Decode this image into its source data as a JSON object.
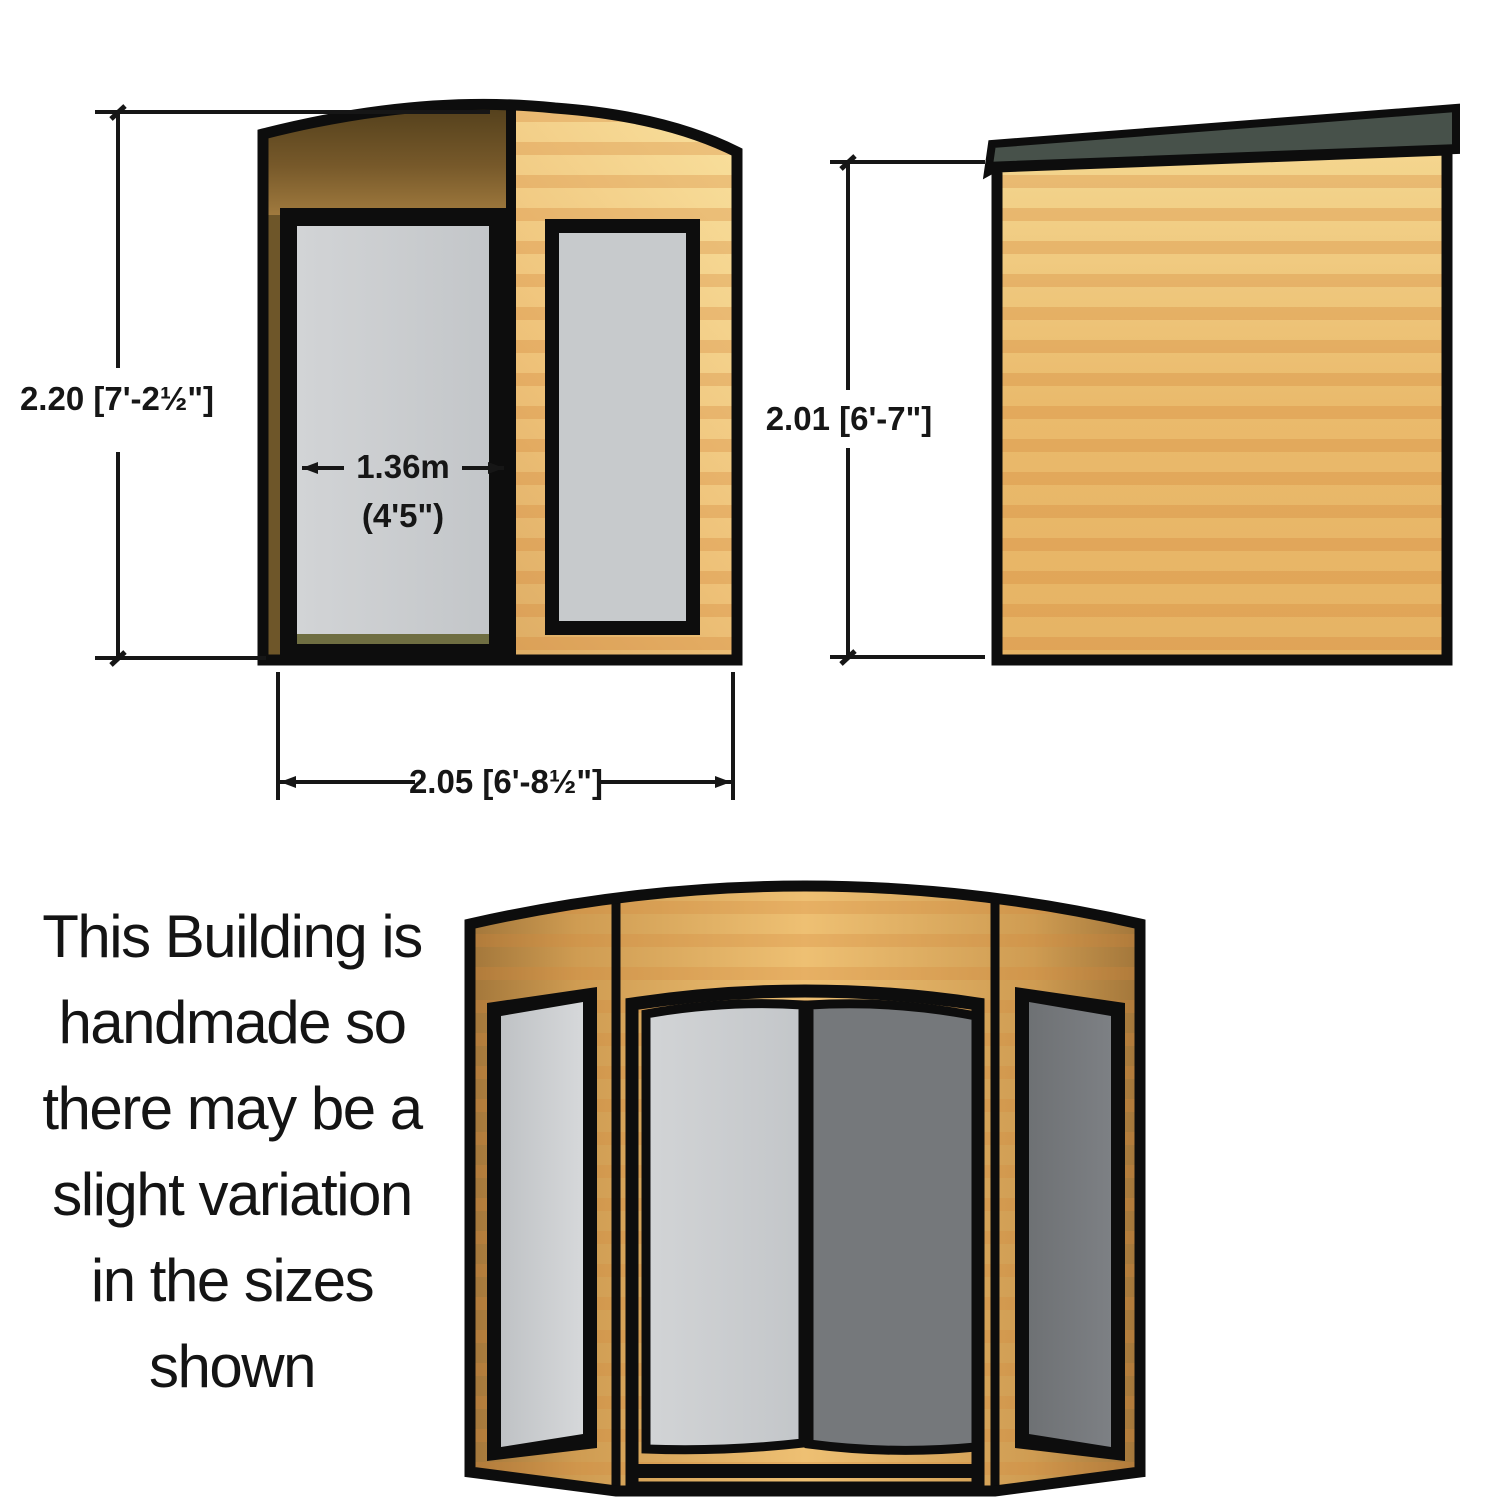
{
  "note": {
    "lines": [
      "This Building is",
      "handmade so",
      "there may be a",
      "slight variation",
      "in the sizes",
      "shown"
    ]
  },
  "dimensions": {
    "front_height": "2.20 [7'-2½\"]",
    "front_width": "2.05 [6'-8½\"]",
    "door_width_metric": "1.36m",
    "door_width_imperial": "(4'5\")",
    "side_height": "2.01 [6'-7\"]"
  },
  "colors": {
    "outline": "#0d0d0d",
    "wood_light": "#eec073",
    "wood_mid": "#cf9c52",
    "wood_dark": "#a2763a",
    "wood_header_dark": "#5a451e",
    "glass_light": "#c7cacc",
    "glass_dark": "#75787b",
    "roof_dark": "#47514a",
    "grain_stripe": "#d4873a"
  }
}
